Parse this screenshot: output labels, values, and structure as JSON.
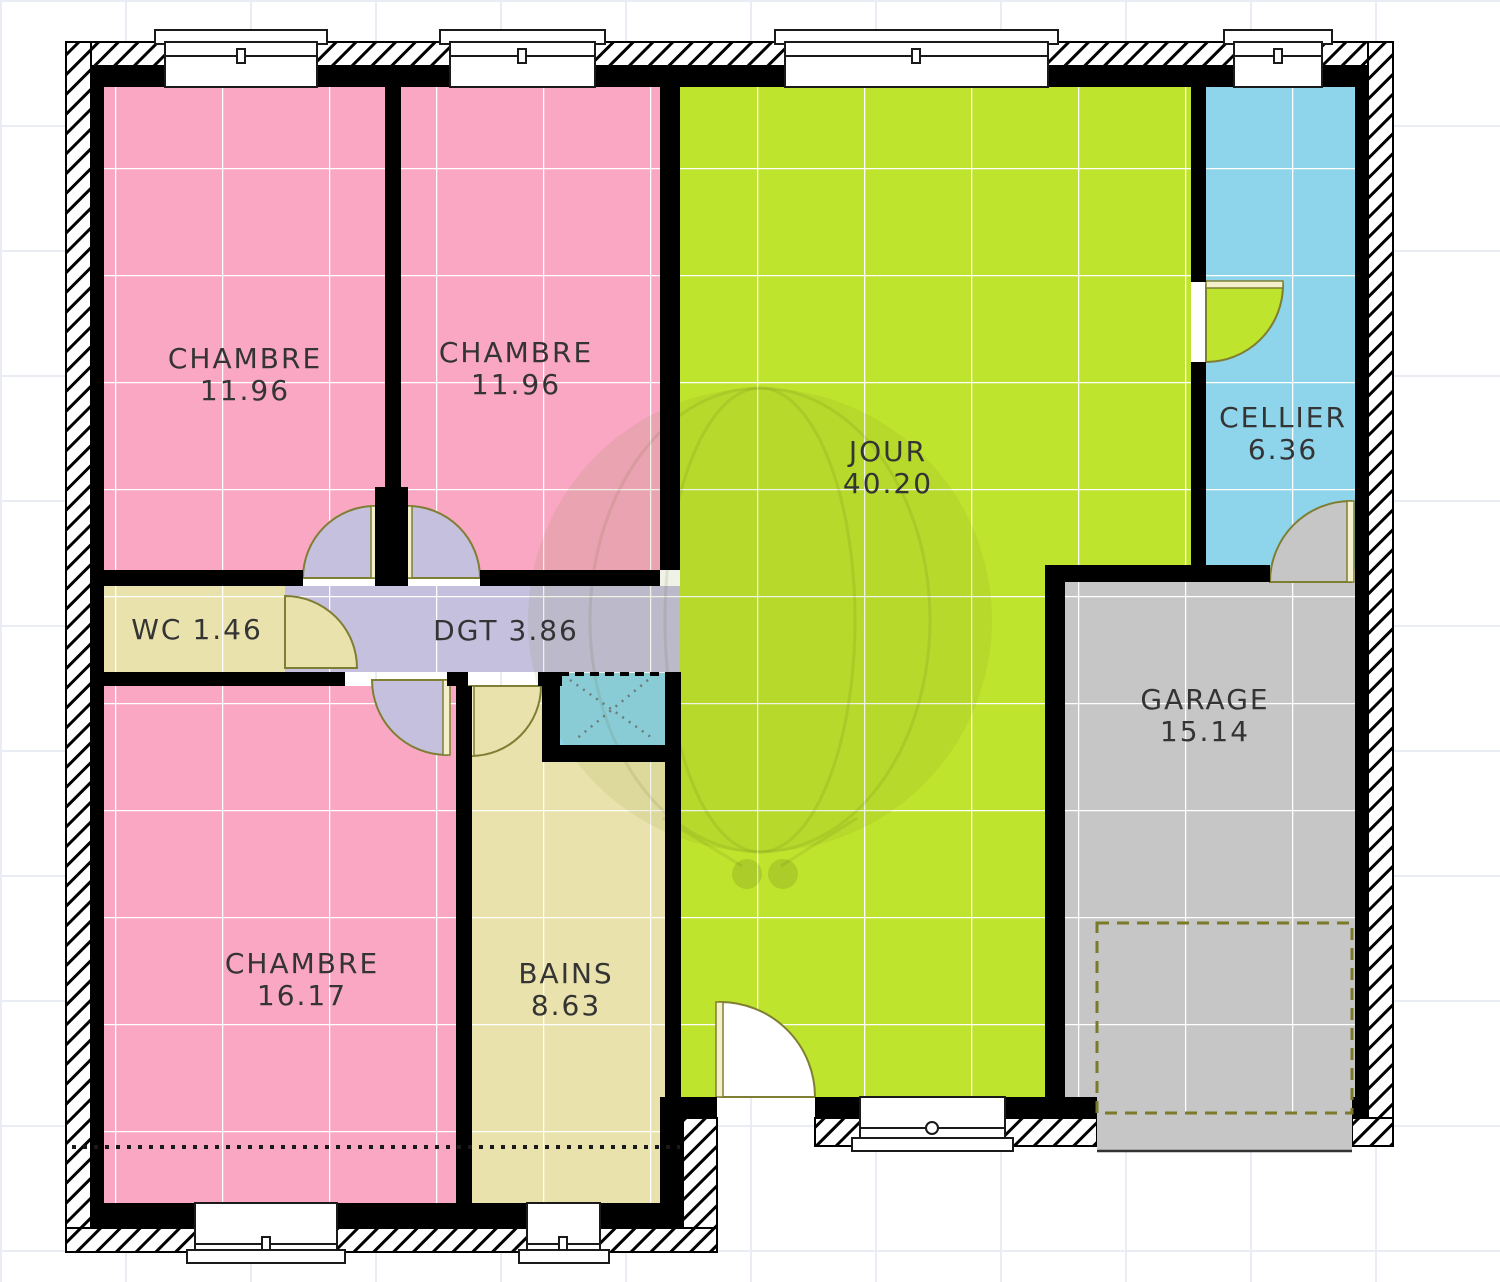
{
  "rooms": {
    "chambre_1": {
      "name": "CHAMBRE",
      "area": "11.96"
    },
    "chambre_2": {
      "name": "CHAMBRE",
      "area": "11.96"
    },
    "jour": {
      "name": "JOUR",
      "area": "40.20"
    },
    "cellier": {
      "name": "CELLIER",
      "area": "6.36"
    },
    "wc": {
      "name": "WC",
      "area": "1.46"
    },
    "dgt": {
      "name": "DGT",
      "area": "3.86"
    },
    "chambre_3": {
      "name": "CHAMBRE",
      "area": "16.17"
    },
    "bains": {
      "name": "BAINS",
      "area": "8.63"
    },
    "garage": {
      "name": "GARAGE",
      "area": "15.14"
    }
  },
  "colors": {
    "bedroom_pink": "#F9A7C2",
    "living_green": "#BFE42E",
    "cellar_blue": "#8ED5EB",
    "hall_lavender": "#C6C0DF",
    "bath_beige": "#EAE2AC",
    "garage_gray": "#C6C6C6"
  }
}
